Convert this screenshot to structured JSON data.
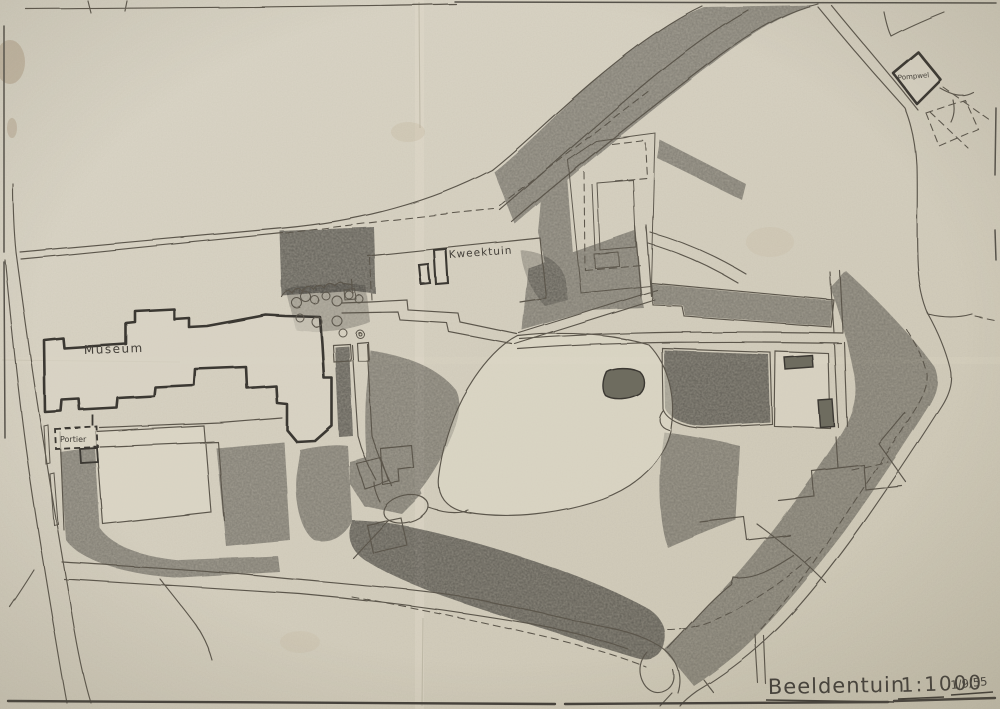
{
  "map": {
    "labels": {
      "museum": "Museum",
      "kweektuin": "Kweektuin",
      "portier": "Portier",
      "pompwel": "Pompwel"
    },
    "title": {
      "name": "Beeldentuin",
      "scale": "1:1000",
      "date": "1/9/55"
    },
    "colors": {
      "paper": "#d9d3c2",
      "pencil_line": "#5b564c",
      "building_outline": "#3b3732",
      "graphite_shade": "#7f7d6d",
      "ink": "#403c35",
      "stain": "#8a6b4a"
    }
  }
}
